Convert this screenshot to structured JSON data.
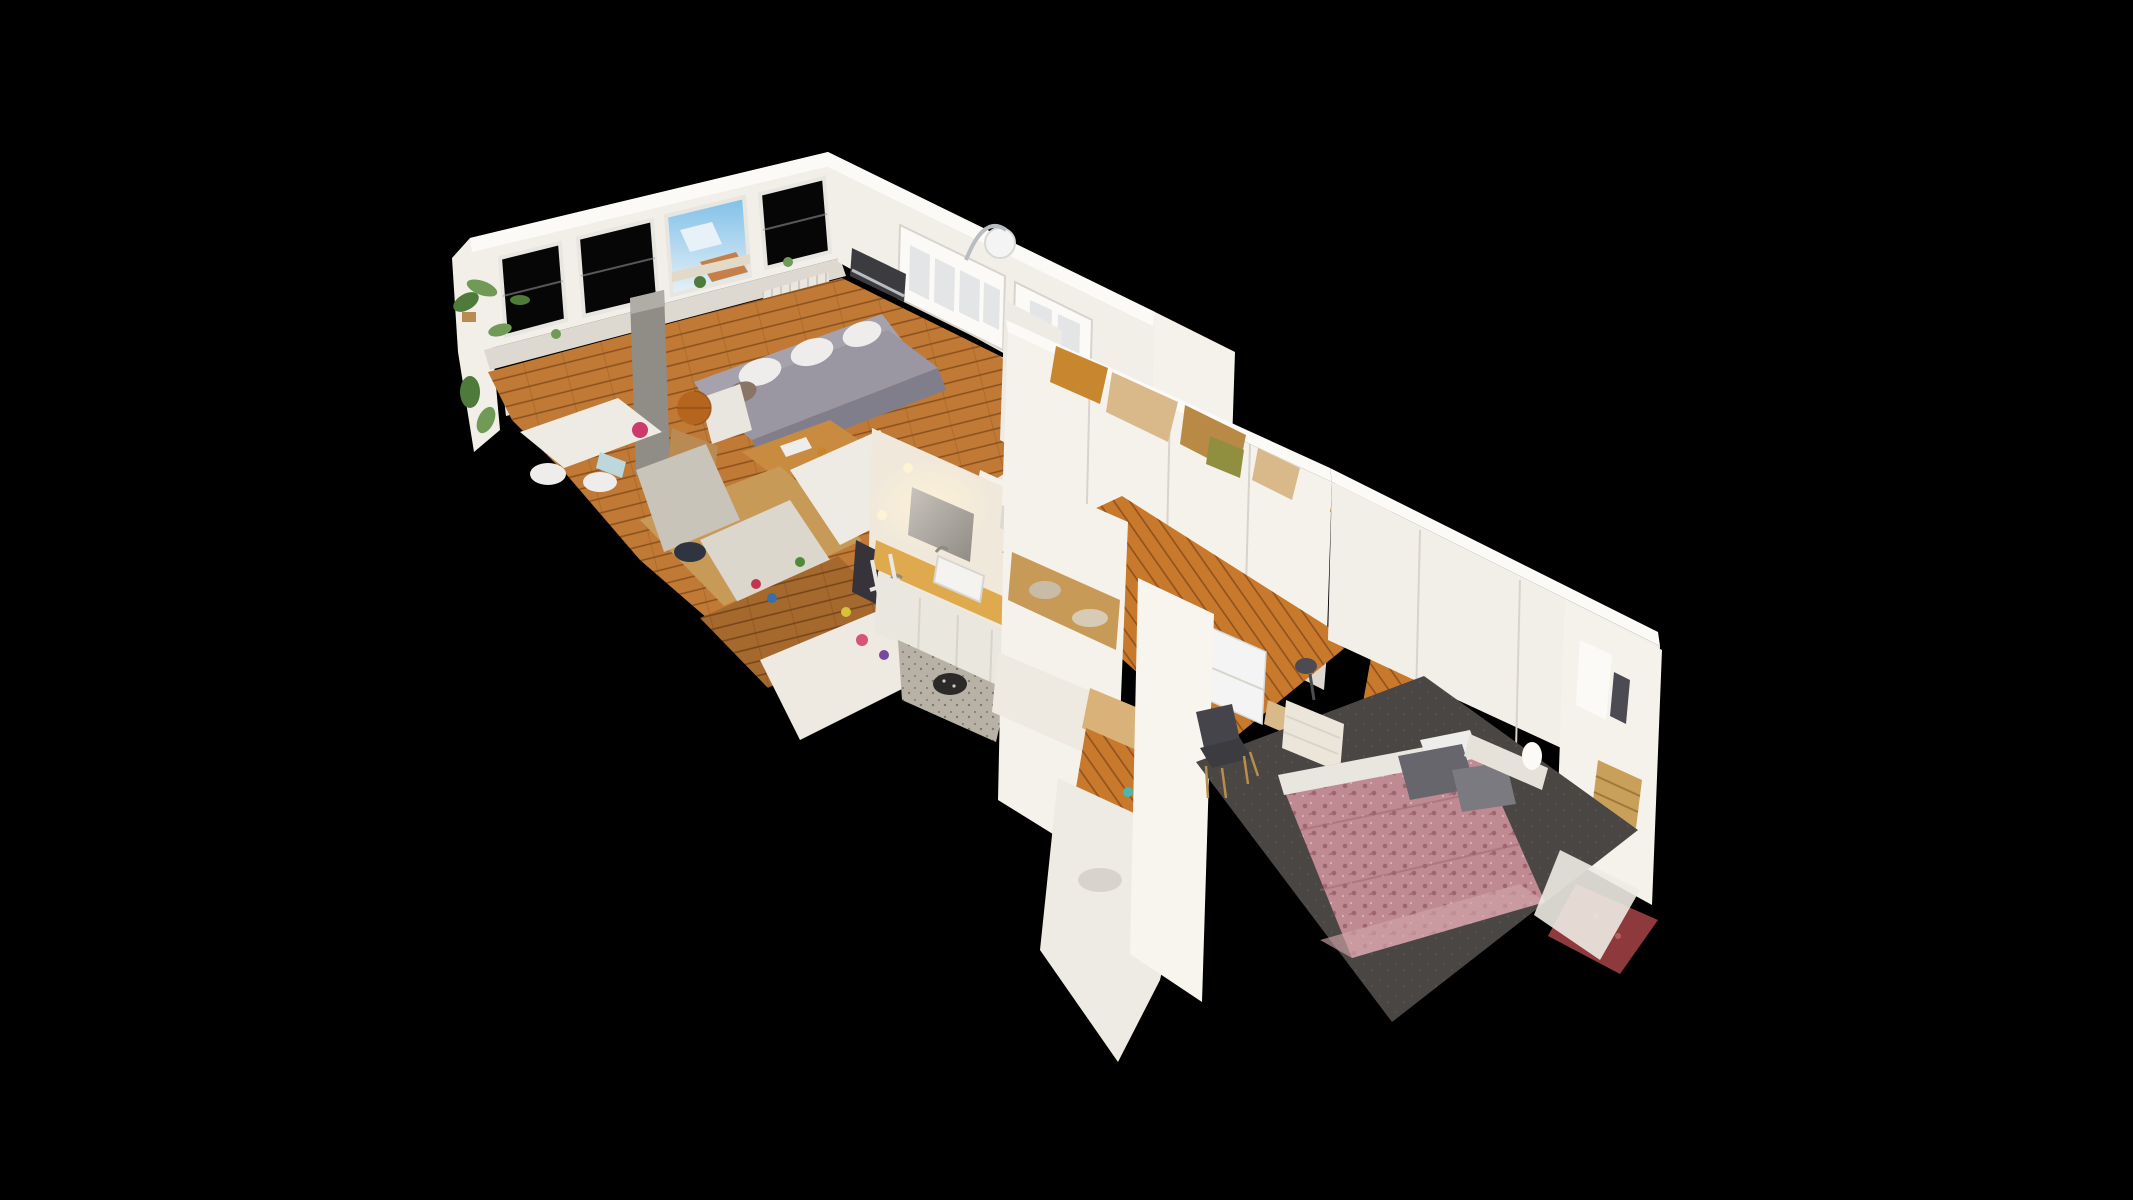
{
  "scene": {
    "palette": {
      "background": "#000000",
      "wall_white": "#f2efe9",
      "wall_bright": "#fbfaf7",
      "wall_shadow": "#ddd8d0",
      "wall_warm": "#f0e8da",
      "wall_cream": "#eeebe4",
      "window_dark": "#060606",
      "window_frame": "#e8e6e1",
      "mullion_grey": "#9a9a9a",
      "sky_blue": "#7fc0e8",
      "sky_light": "#e8f1f7",
      "roof_orange": "#c77f4a",
      "facade_cream": "#e3d9c8",
      "wood_floor": "#c07a35",
      "wood_floor_dark": "#8a4f1d",
      "wood_hall": "#c8792c",
      "counter_wood": "#dfa94e",
      "tile_blue": "#d7e7ec",
      "tile_line": "#b3cdd6",
      "sofa_grey": "#9a97a3",
      "sofa_grey_dark": "#817e8b",
      "sofa_back": "#a5a2ad",
      "pillow_white": "#efedeb",
      "pillow_tan": "#8a7468",
      "radiator_base": "#eae7e1",
      "radiator_line": "#cfcbc3",
      "globe_orange": "#b5651d",
      "globe_line": "#8a4a12",
      "table_wood": "#c98b3f",
      "cart_wood": "#b98a52",
      "column_grey": "#908c86",
      "column_light": "#b0aca6",
      "plant_green": "#6f9b57",
      "plant_green_dark": "#4e7a3a",
      "magenta": "#cf3a6e",
      "light_blue_box": "#bcd8de",
      "oven_black": "#141414",
      "hood_grey": "#3c3c40",
      "steel": "#b9bdc2",
      "appliance_white": "#dfe0e2",
      "appliance_window": "#2a2a2e",
      "bread_tan": "#d9b06a",
      "clutter_navy": "#2e3440",
      "dish_blue": "#4a6378",
      "beige_patch": "#c89a58",
      "grey_sheet": "#c9c4ba",
      "grey_sheet_light": "#dbd7cd",
      "mirror_light": "#c9c5bd",
      "mirror_dark": "#8f8b84",
      "glow_warm": "#fff3d6",
      "sink_white": "#f4f3ef",
      "cabinet_white": "#eae7df",
      "clothes_dark": "#36343a",
      "bath_floor": "#b7b1a6",
      "bath_floor_speck": "#7d776c",
      "stool_black": "#2c2a28",
      "wardrobe_seam": "#d8d3cb",
      "torn_orange": "#c8872f",
      "torn_tan": "#d9b98a",
      "torn_brown": "#b98a45",
      "olive_box": "#8f8f3f",
      "panel_white": "#f5f2ec",
      "panel_white2": "#f8f5ef",
      "bench_white": "#eeeae2",
      "board_tan": "#d9b27a",
      "fridge_white": "#f4f4f4",
      "carpet_dark": "#4a4644",
      "carpet_speck": "#57534f",
      "bed_base": "#c08a92",
      "bed_pattern": "#9e6570",
      "bed_speck": "#d9b3b8",
      "bed_fold": "#cfa3a9",
      "bed_sheet": "#e9e5df",
      "pillow_grey1": "#67666c",
      "pillow_grey2": "#7b7a80",
      "headboard": "#e6e2da",
      "nightstand": "#ebe6d9",
      "lamp_dark": "#4c4a52",
      "chair_dark": "#3c3b40",
      "chair_back": "#45444a",
      "chair_leg": "#b98e4a",
      "crate_wood": "#c9a05a",
      "crate_line": "#a1773a",
      "rug_red": "#8e3a3c",
      "rug_red_light": "#b06062",
      "teal": "#4ab8b0",
      "speck_red": "#c2354f",
      "speck_blue": "#3a6ea8",
      "speck_green": "#4e8a3a",
      "speck_pink": "#d4547a",
      "speck_yellow": "#d9c23a",
      "speck_purple": "#7a4a9a"
    }
  }
}
